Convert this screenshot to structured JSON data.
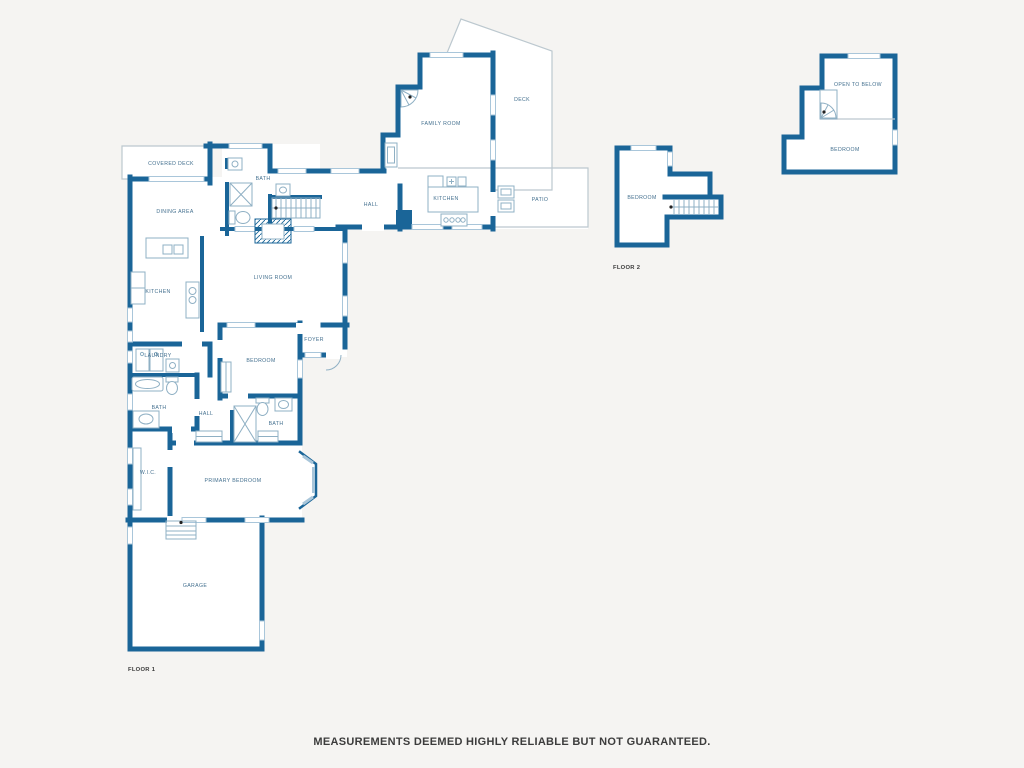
{
  "page": {
    "disclaimer": "MEASUREMENTS DEEMED HIGHLY RELIABLE BUT NOT GUARANTEED."
  },
  "colors": {
    "background": "#f5f4f2",
    "room_fill": "#ffffff",
    "wall": "#1a6598",
    "window": "#a9c6da",
    "fixture": "#8fb0c4",
    "outdoor_outline": "#bcc8cf",
    "room_label": "#44708f",
    "floor_label": "#3a3a3a",
    "disclaimer_text": "#3c3c3c"
  },
  "floor_labels": [
    {
      "id": "floor-1",
      "label": "FLOOR 1",
      "x": 128,
      "y": 671
    },
    {
      "id": "floor-2",
      "label": "FLOOR 2",
      "x": 613,
      "y": 269
    }
  ],
  "rooms": [
    {
      "id": "covered-deck",
      "label": "COVERED DECK",
      "x": 171,
      "y": 165,
      "floor": 1
    },
    {
      "id": "dining-area",
      "label": "DINING AREA",
      "x": 175,
      "y": 213,
      "floor": 1
    },
    {
      "id": "bath-upper",
      "label": "BATH",
      "x": 263,
      "y": 180,
      "floor": 1
    },
    {
      "id": "hall-upper",
      "label": "HALL",
      "x": 371,
      "y": 206,
      "floor": 1
    },
    {
      "id": "family-room",
      "label": "FAMILY ROOM",
      "x": 441,
      "y": 125,
      "floor": 1
    },
    {
      "id": "deck",
      "label": "DECK",
      "x": 522,
      "y": 101,
      "floor": 1
    },
    {
      "id": "kitchen-upper",
      "label": "KITCHEN",
      "x": 446,
      "y": 200,
      "floor": 1
    },
    {
      "id": "patio",
      "label": "PATIO",
      "x": 540,
      "y": 201,
      "floor": 1
    },
    {
      "id": "kitchen",
      "label": "KITCHEN",
      "x": 158,
      "y": 293,
      "floor": 1
    },
    {
      "id": "living-room",
      "label": "LIVING ROOM",
      "x": 273,
      "y": 279,
      "floor": 1
    },
    {
      "id": "foyer",
      "label": "FOYER",
      "x": 314,
      "y": 341,
      "floor": 1
    },
    {
      "id": "bedroom",
      "label": "BEDROOM",
      "x": 261,
      "y": 362,
      "floor": 1
    },
    {
      "id": "laundry",
      "label": "LAUNDRY",
      "x": 158,
      "y": 357,
      "floor": 1
    },
    {
      "id": "bath-left",
      "label": "BATH",
      "x": 159,
      "y": 409,
      "floor": 1
    },
    {
      "id": "hall-lower",
      "label": "HALL",
      "x": 206,
      "y": 415,
      "floor": 1
    },
    {
      "id": "bath-middle",
      "label": "BATH",
      "x": 276,
      "y": 425,
      "floor": 1
    },
    {
      "id": "wic",
      "label": "W.I.C.",
      "x": 148,
      "y": 474,
      "floor": 1
    },
    {
      "id": "primary-bedroom",
      "label": "PRIMARY BEDROOM",
      "x": 233,
      "y": 482,
      "floor": 1
    },
    {
      "id": "garage",
      "label": "GARAGE",
      "x": 195,
      "y": 587,
      "floor": 1
    },
    {
      "id": "bedroom-f2-left",
      "label": "BEDROOM",
      "x": 642,
      "y": 199,
      "floor": 2
    },
    {
      "id": "open-to-below",
      "label": "OPEN TO BELOW",
      "x": 858,
      "y": 86,
      "floor": 2
    },
    {
      "id": "bedroom-f2-right",
      "label": "BEDROOM",
      "x": 845,
      "y": 151,
      "floor": 2
    }
  ]
}
